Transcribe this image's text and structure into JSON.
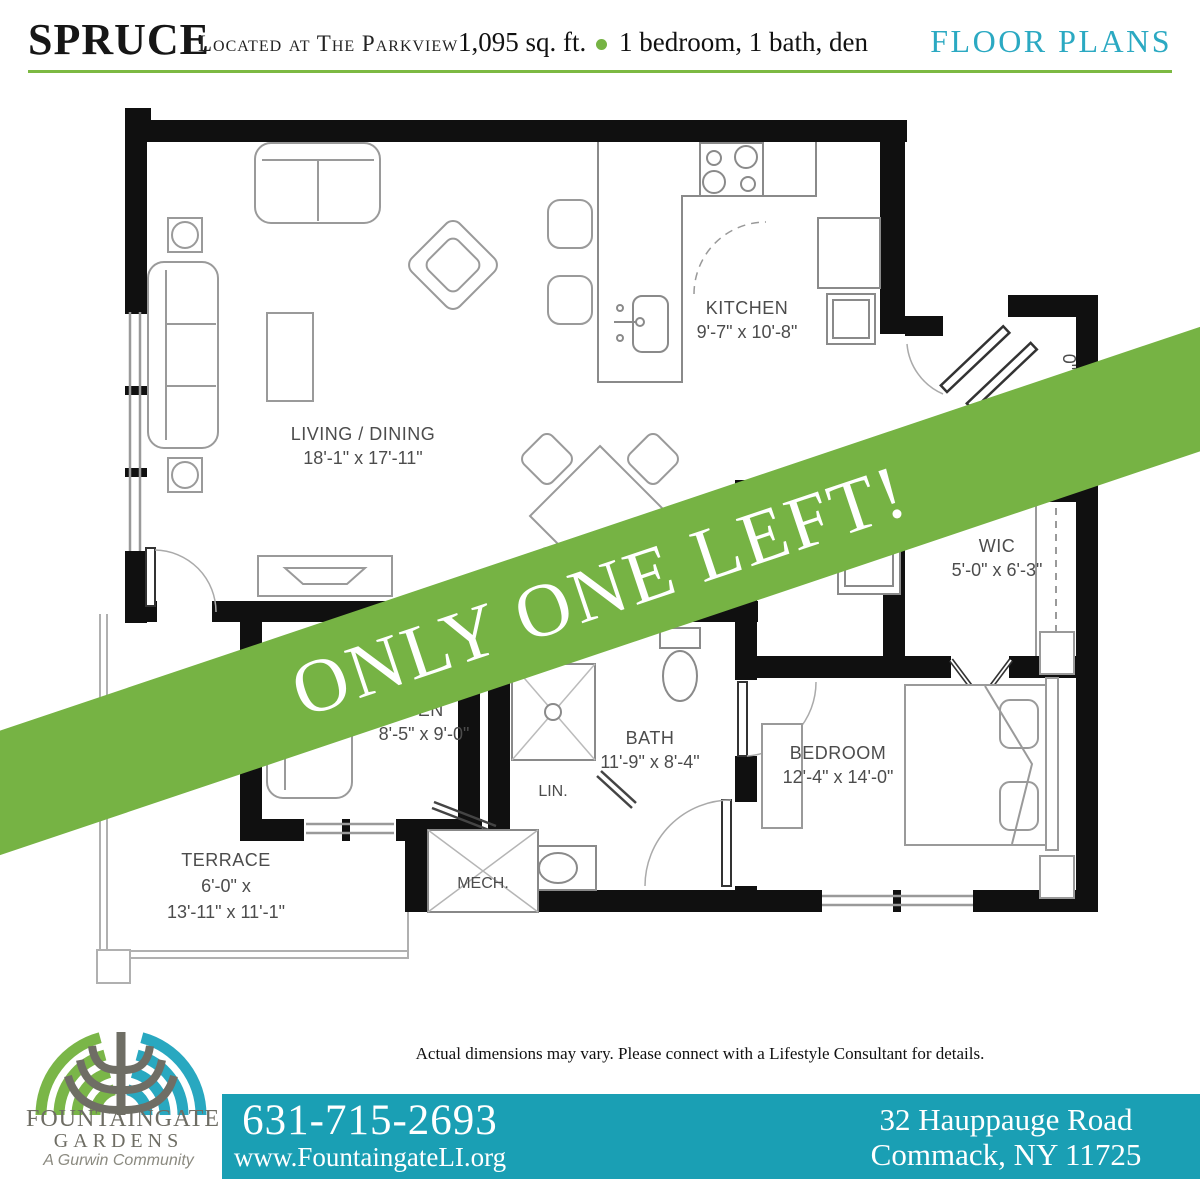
{
  "header": {
    "title": "SPRUCE",
    "subtitle": "Located at The Parkview",
    "sqft": "1,095 sq. ft.",
    "features": "1 bedroom, 1 bath, den",
    "section": "FLOOR PLANS"
  },
  "banner": {
    "text": "ONLY ONE LEFT!"
  },
  "plan": {
    "living": {
      "name": "LIVING / DINING",
      "dims": "18'-1\" x 17'-11\""
    },
    "kitchen": {
      "name": "KITCHEN",
      "dims": "9'-7\" x 10'-8\""
    },
    "wic": {
      "name": "WIC",
      "dims": "5'-0\" x 6'-3\""
    },
    "den": {
      "name": "DEN",
      "dims": "8'-5\" x 9'-0\""
    },
    "bath": {
      "name": "BATH",
      "dims": "11'-9\" x 8'-4\""
    },
    "linen": {
      "name": "LIN."
    },
    "mech": {
      "name": "MECH."
    },
    "bedroom": {
      "name": "BEDROOM",
      "dims": "12'-4\" x 14'-0\""
    },
    "terrace": {
      "name": "TERRACE",
      "dims_line1": "6'-0\" x",
      "dims_line2": "13'-11\" x 11'-1\""
    },
    "dim_fragment": "0\""
  },
  "disclaimer": "Actual dimensions may vary. Please connect with a Lifestyle Consultant for details.",
  "footer": {
    "logo_name_line1": "FOUNTAINGATE",
    "logo_name_line2": "GARDENS",
    "logo_tagline": "A Gurwin Community",
    "phone": "631-715-2693",
    "website": "www.FountaingateLI.org",
    "address_line1": "32 Hauppauge Road",
    "address_line2": "Commack, NY 11725"
  },
  "colors": {
    "banner_green": "#76b344",
    "rule_green": "#7cb942",
    "teal_bar": "#1a9fb4",
    "teal_text": "#2ba9c2"
  }
}
